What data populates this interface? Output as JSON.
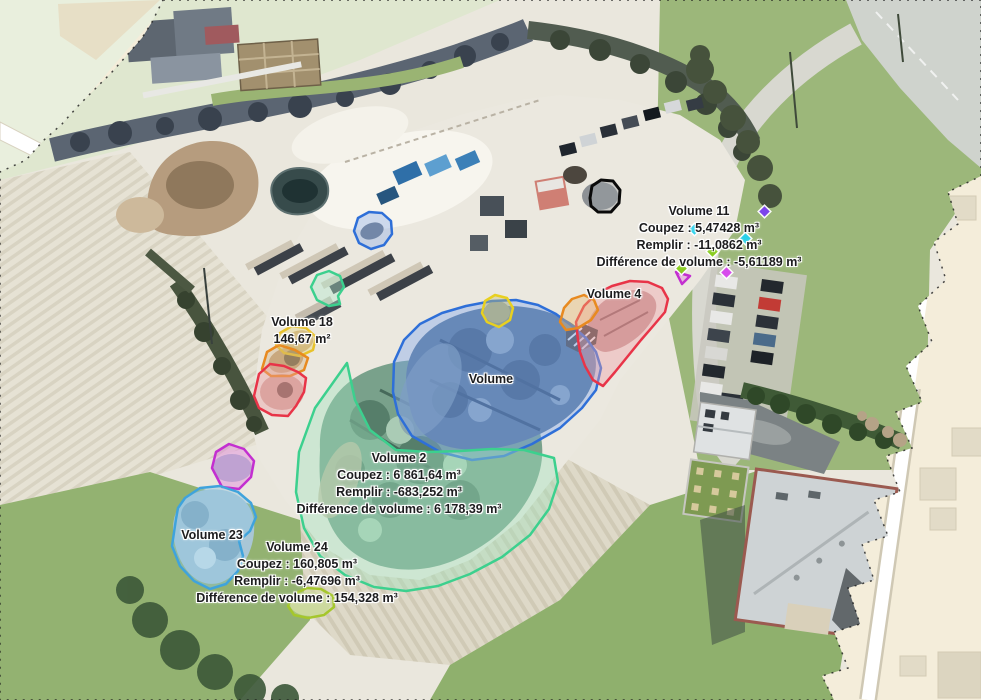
{
  "view": {
    "type": "orthophoto-volume-measurement-map",
    "language": "fr",
    "units": {
      "area": "m²",
      "volume": "m³"
    }
  },
  "colors": {
    "basemap": "#f4edda",
    "volume_blue": "#2e6fd8",
    "volume_green": "#3cd08e",
    "volume_red": "#e83448",
    "volume_orange": "#e88a20",
    "volume_yellow": "#e8c22a",
    "volume_magenta": "#c32fd0",
    "volume_lightblue": "#3fa3dc",
    "volume_chartreuse": "#a5c72c",
    "volume_black": "#0a0a0a"
  },
  "annotations": {
    "volume11": {
      "title": "Volume 11",
      "lines": [
        "Coupez : 5,47428 m³",
        "Remplir : -11,0862 m³",
        "Différence de volume : -5,61189 m³"
      ]
    },
    "volume4": {
      "title": "Volume 4"
    },
    "volume18": {
      "title": "Volume 18",
      "lines": [
        "146,67 m²"
      ]
    },
    "volume": {
      "title": "Volume"
    },
    "volume2": {
      "title": "Volume 2",
      "lines": [
        "Coupez : 6 861,64 m³",
        "Remplir : -683,252 m³",
        "Différence de volume : 6 178,39 m³"
      ]
    },
    "volume23": {
      "title": "Volume 23"
    },
    "volume24": {
      "title": "Volume 24",
      "lines": [
        "Coupez : 160,805 m³",
        "Remplir : -6,47696 m³",
        "Différence de volume : 154,328 m³"
      ]
    }
  }
}
